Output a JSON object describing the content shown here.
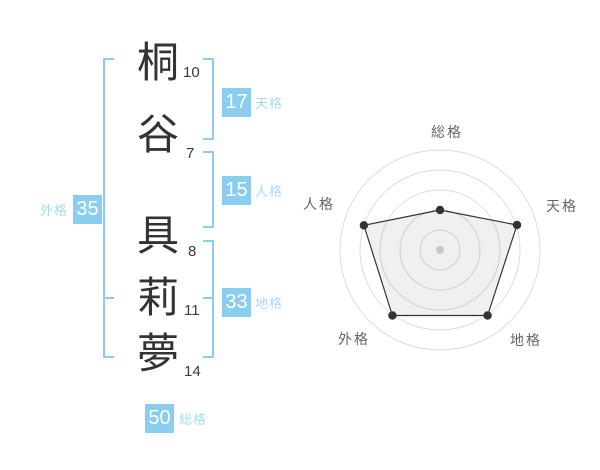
{
  "name_analysis": {
    "characters": [
      {
        "char": "桐",
        "strokes": "10",
        "group": "surname"
      },
      {
        "char": "谷",
        "strokes": "7",
        "group": "surname"
      },
      {
        "char": "具",
        "strokes": "8",
        "group": "given"
      },
      {
        "char": "莉",
        "strokes": "11",
        "group": "given"
      },
      {
        "char": "夢",
        "strokes": "14",
        "group": "given"
      }
    ],
    "kaku": {
      "tenkaku": {
        "label": "天格",
        "value": "17"
      },
      "jinkaku": {
        "label": "人格",
        "value": "15"
      },
      "chikaku": {
        "label": "地格",
        "value": "33"
      },
      "gaikaku": {
        "label": "外格",
        "value": "35"
      },
      "soukaku": {
        "label": "総格",
        "value": "50"
      }
    },
    "colors": {
      "accent": "#8BCDEF",
      "kaku_label_text": "#A5DBF6",
      "value_text": "#ffffff",
      "kanji_text": "#333333"
    }
  },
  "chart_data": {
    "type": "radar",
    "axes": [
      "総格",
      "天格",
      "地格",
      "外格",
      "人格"
    ],
    "values": [
      40,
      81,
      81,
      81,
      80
    ],
    "scale_max": 100,
    "ring_count": 5,
    "ring_step": 20,
    "grid": "concentric-circles",
    "legend_position": "none",
    "title": "",
    "colors": {
      "grid": "#dcdcdc",
      "line": "#333333",
      "fill": "rgba(0,0,0,0.06)",
      "vertex_dot": "#333333",
      "center_dot": "#c9c9c9",
      "label": "#666666"
    }
  }
}
